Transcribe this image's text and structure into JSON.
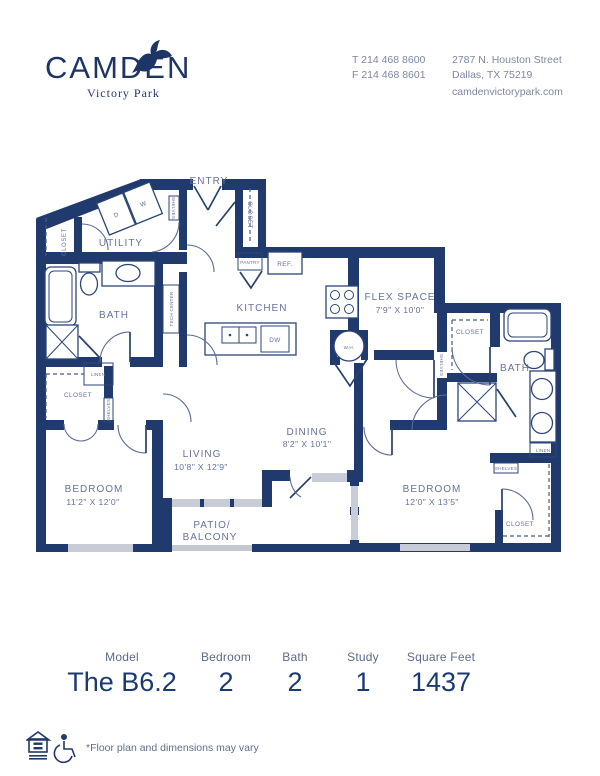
{
  "header": {
    "brand": "CAMDEN",
    "brand_sub": "Victory Park",
    "phone1": "T 214 468 8600",
    "phone2": "F 214 468 8601",
    "address1": "2787 N. Houston Street",
    "address2": "Dallas, TX 75219",
    "website": "camdenvictorypark.com"
  },
  "floorplan": {
    "entry": "ENTRY",
    "utility": "UTILITY",
    "kitchen": "KITCHEN",
    "bath": "BATH",
    "closet": "CLOSET",
    "linen": "LINEN",
    "shelves": "SHELVES",
    "tech_center": "TECH CENTER",
    "pantry": "PANTRY",
    "ref": "REF.",
    "dw": "DW",
    "wh": "W.H.",
    "washer": "W",
    "dryer": "D",
    "flex_name": "FLEX SPACE",
    "flex_dim": "7'9\" X 10'0\"",
    "dining_name": "DINING",
    "dining_dim": "8'2\" X 10'1\"",
    "living_name": "LIVING",
    "living_dim": "10'8\" X 12'9\"",
    "bedroom1_name": "BEDROOM",
    "bedroom1_dim": "11'2\" X 12'0\"",
    "bedroom2_name": "BEDROOM",
    "bedroom2_dim": "12'0\" X 13'5\"",
    "patio_line1": "PATIO/",
    "patio_line2": "BALCONY"
  },
  "summary": {
    "columns": [
      {
        "label": "Model",
        "value": "The B6.2"
      },
      {
        "label": "Bedroom",
        "value": "2"
      },
      {
        "label": "Bath",
        "value": "2"
      },
      {
        "label": "Study",
        "value": "1"
      },
      {
        "label": "Square Feet",
        "value": "1437"
      }
    ]
  },
  "footer": {
    "disclaimer": "*Floor plan and dimensions may vary"
  },
  "colors": {
    "wall_navy": "#203a6d",
    "label_slate": "#66729b",
    "window_gray": "#c7ccd6"
  }
}
